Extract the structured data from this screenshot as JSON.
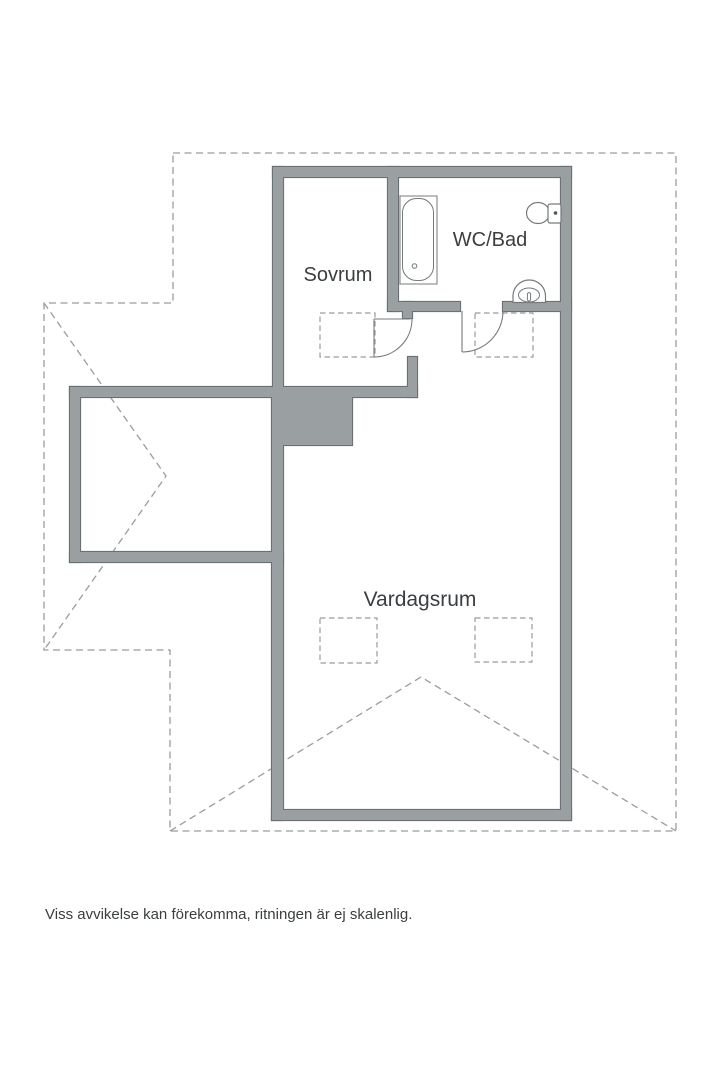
{
  "floor_plan": {
    "rooms": [
      {
        "name": "Sovrum"
      },
      {
        "name": "WC/Bad"
      },
      {
        "name": "Vardagsrum"
      }
    ],
    "fixtures": [
      {
        "name": "bathtub"
      },
      {
        "name": "toilet"
      },
      {
        "name": "sink"
      }
    ],
    "disclaimer": "Viss avvikelse kan förekomma, ritningen är ej skalenlig.",
    "colors": {
      "wall_fill": "#9aa0a2",
      "wall_outline": "#6b7173",
      "fixture_line": "#757a7c",
      "dashed_line": "#989da0",
      "label_text": "#3b3e40",
      "background": "#ffffff"
    }
  }
}
